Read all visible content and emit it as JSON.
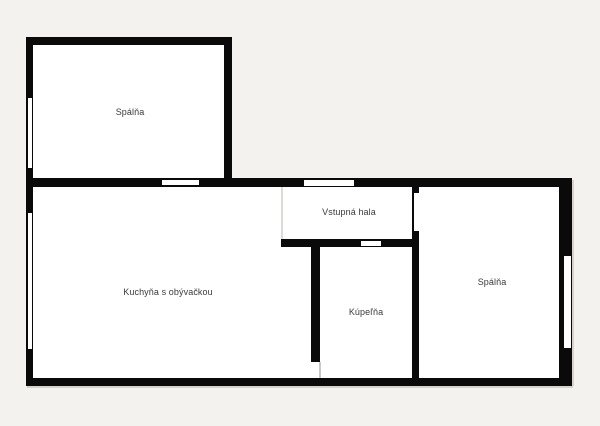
{
  "plan": {
    "background_color": "#f3f2ef",
    "wall_color": "#0a0a0a",
    "room_fill_color": "#ffffff",
    "label_color": "#3a3a3a",
    "rooms": [
      {
        "label": "Spálňa"
      },
      {
        "label": "Vstupná hala"
      },
      {
        "label": "Kuchyňa s obývačkou"
      },
      {
        "label": "Kúpeľňa"
      },
      {
        "label": "Spálňa"
      }
    ]
  }
}
